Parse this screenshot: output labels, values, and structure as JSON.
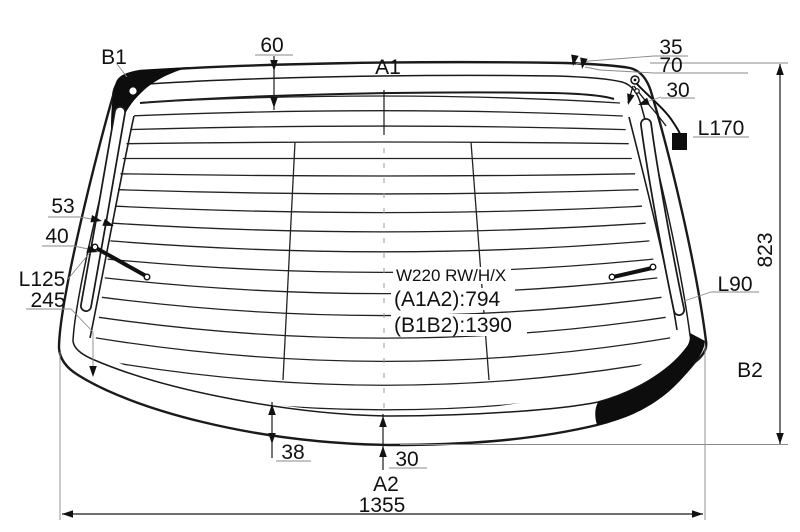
{
  "drawing": {
    "colors": {
      "line": "#1a1a1a",
      "background": "#ffffff",
      "ceramic": "#0d0d0d"
    },
    "labels": {
      "b1": "B1",
      "a1": "A1",
      "a2": "A2",
      "b2": "B2",
      "l170": "L170",
      "l125": "L125",
      "l90": "L90",
      "model": "W220 RW/H/X",
      "a1a2": "(A1A2):794",
      "b1b2": "(B1B2):1390"
    },
    "dims": {
      "top_band": "60",
      "top_right_1": "35",
      "top_right_2": "70",
      "top_right_3": "30",
      "left_1": "53",
      "left_2": "40",
      "left_3": "245",
      "bottom_1": "38",
      "bottom_2": "30",
      "overall_width": "1355",
      "overall_height": "823"
    }
  }
}
